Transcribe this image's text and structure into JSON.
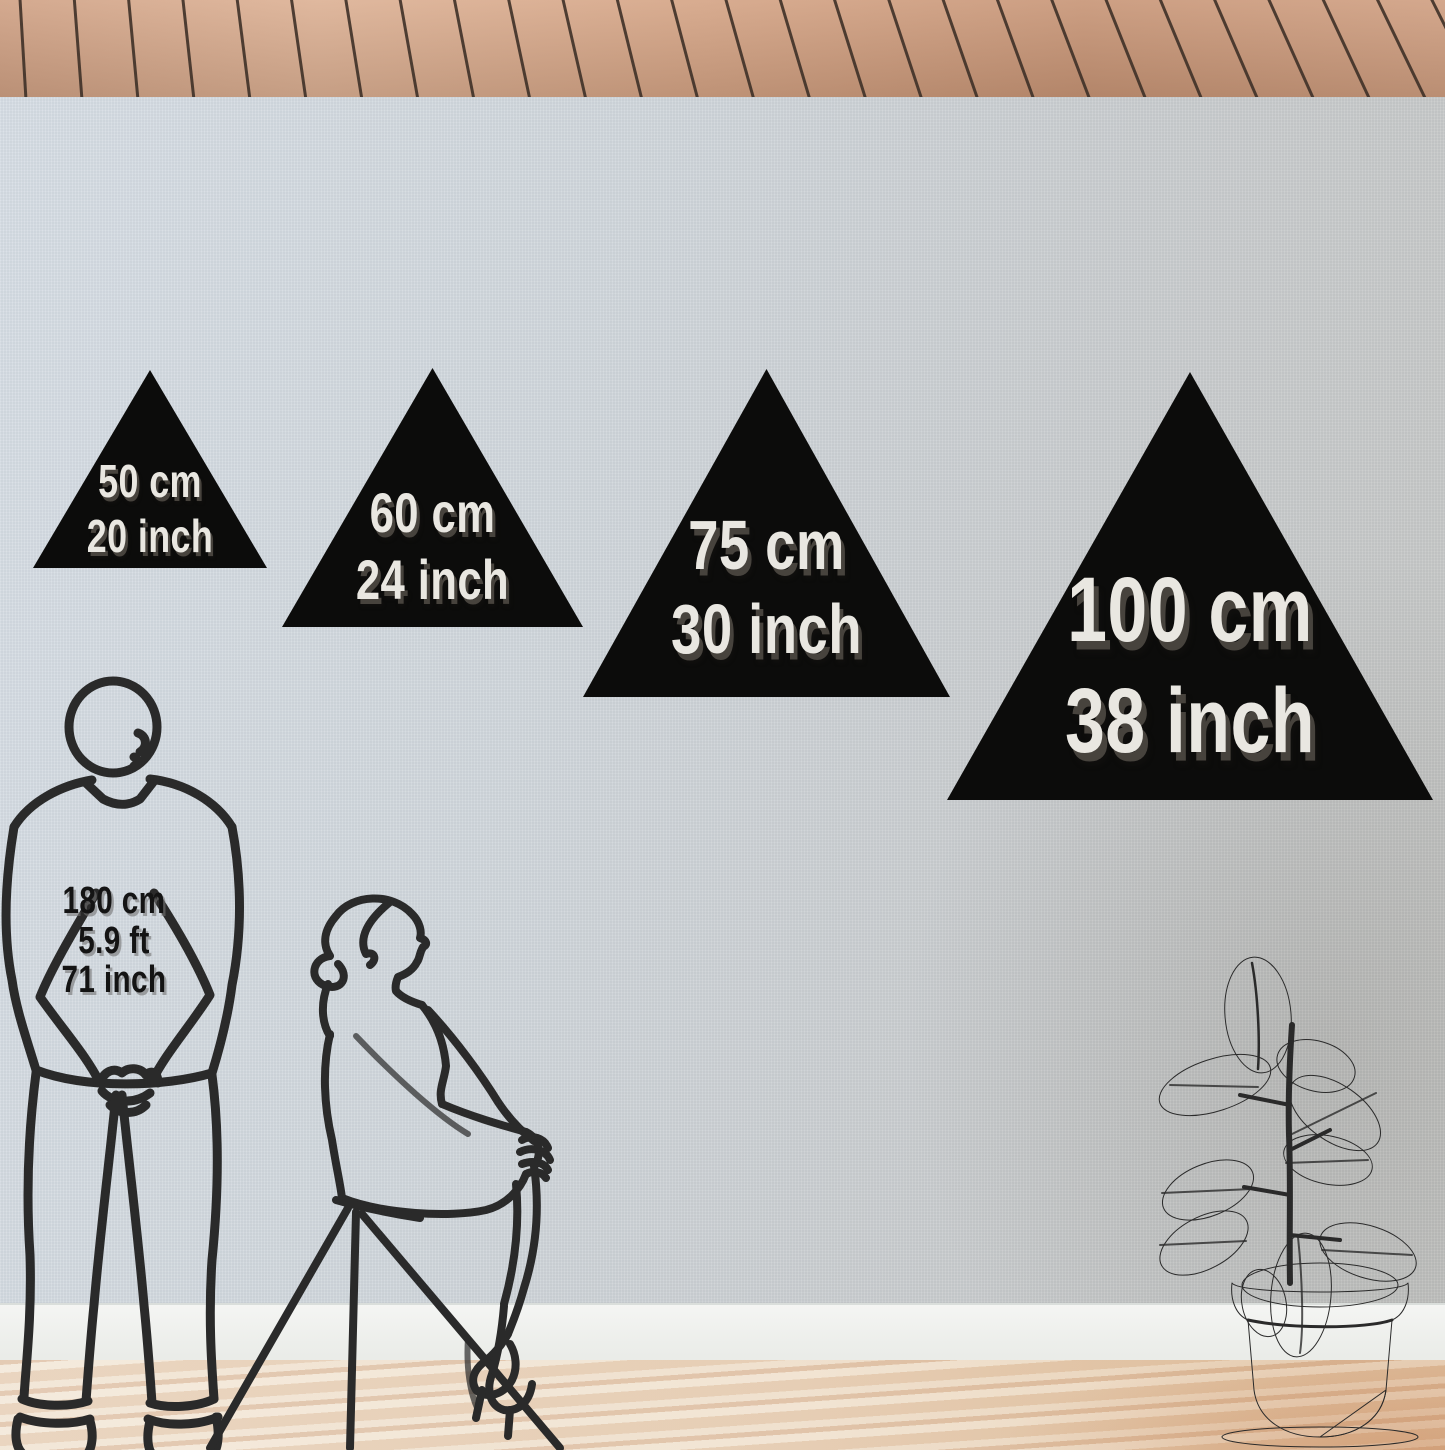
{
  "triangles": [
    {
      "cm": "50 cm",
      "inch": "20 inch"
    },
    {
      "cm": "60 cm",
      "inch": "24 inch"
    },
    {
      "cm": "75 cm",
      "inch": "30 inch"
    },
    {
      "cm": "100 cm",
      "inch": "38 inch"
    }
  ],
  "person_height": {
    "cm": "180 cm",
    "ft": "5.9 ft",
    "inch": "71 inch"
  },
  "colors": {
    "triangle": "#0c0c0b",
    "triangle_text": "#e9e7e1",
    "triangle_text_shadow": "#47433d",
    "line_art": "#2a2a2a",
    "ceiling_wood": "#d4a384",
    "wall": "#d2d8dd",
    "baseboard": "#f0f2ef",
    "floor": "#ecdac4"
  }
}
